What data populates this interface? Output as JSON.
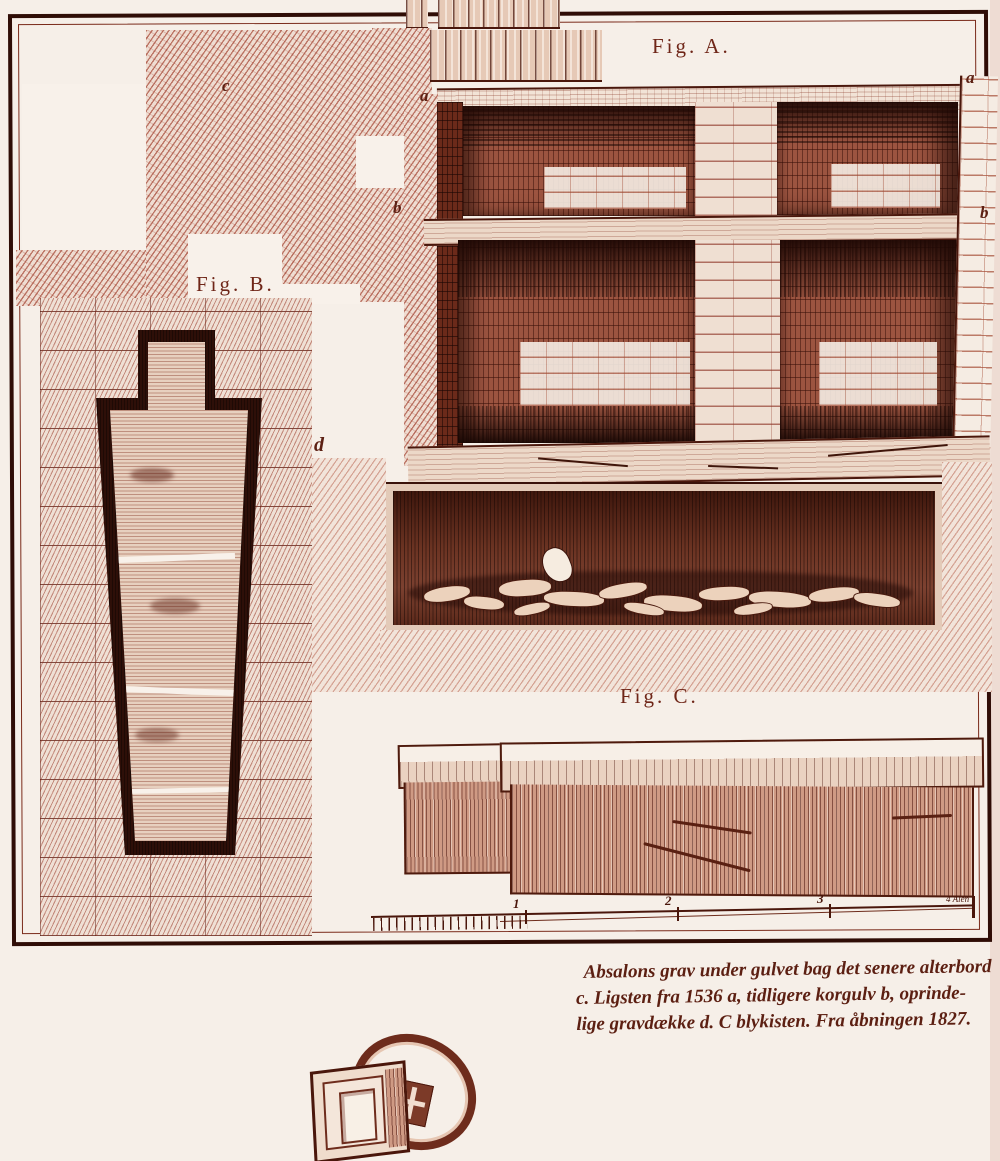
{
  "plate": {
    "figure_a_label": "Fig. A.",
    "figure_b_label": "Fig. B.",
    "figure_c_label": "Fig. C.",
    "marker_a_left": "a",
    "marker_a_right": "a",
    "marker_b_left": "b",
    "marker_b_right": "b",
    "marker_c": "c",
    "marker_d": "d",
    "scale_bar": {
      "tick_labels": [
        "1",
        "2",
        "3"
      ],
      "end_label": "4 Alen"
    }
  },
  "caption": {
    "line1": "Absalons grav under gulvet bag det senere alterbord",
    "line2": "c. Ligsten fra 1536 a, tidligere korgulv b, oprinde-",
    "line3": "lige gravdække d. C blykisten. Fra åbningen 1827."
  },
  "colors": {
    "paper": "#f6efe8",
    "ink": "#43140a",
    "hatch": "#a34a32",
    "stone": "#ecd8c8",
    "dark": "#3a130b"
  }
}
